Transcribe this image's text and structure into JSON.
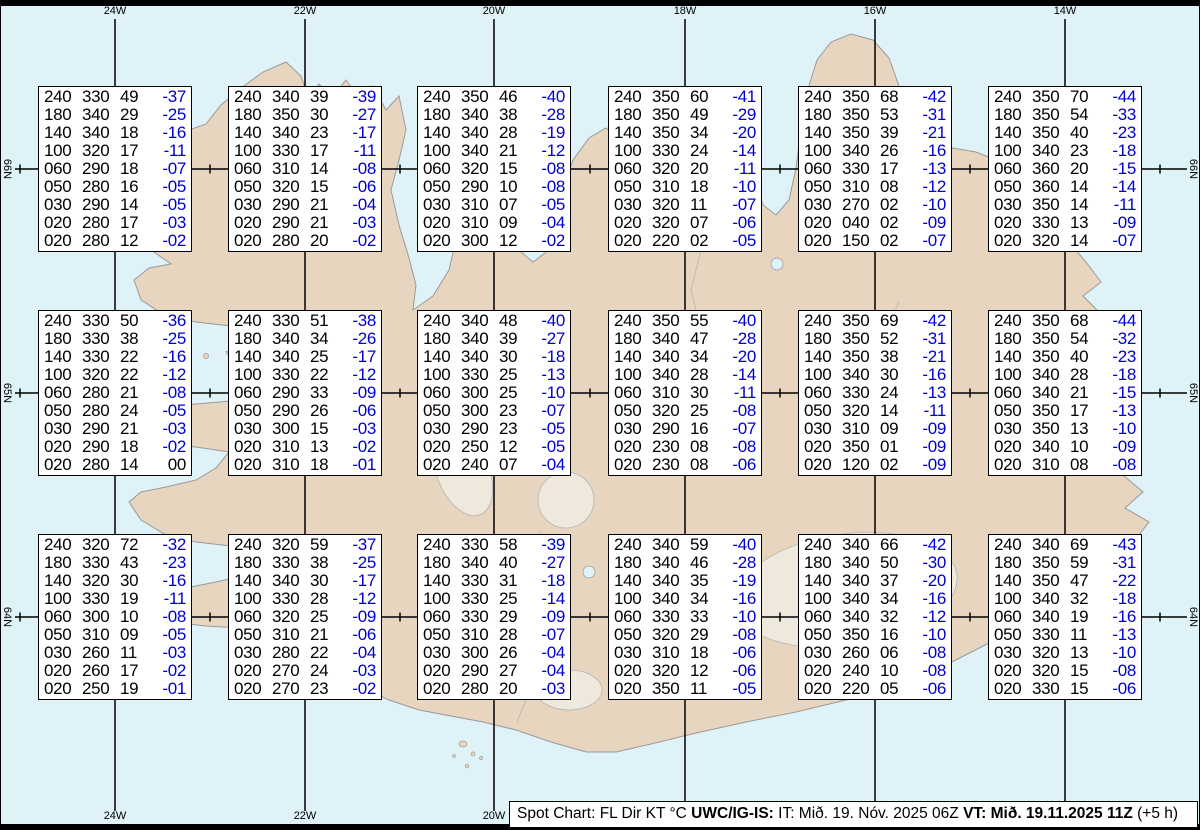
{
  "map": {
    "sea_color": "#dff2f8",
    "land_color": "#e7d5c0",
    "coast_color": "#9a9a9a",
    "grid_color": "#000000",
    "meridians": [
      {
        "label": "24W",
        "x": 114
      },
      {
        "label": "22W",
        "x": 304
      },
      {
        "label": "20W",
        "x": 493
      },
      {
        "label": "18W",
        "x": 684
      },
      {
        "label": "16W",
        "x": 874
      },
      {
        "label": "14W",
        "x": 1064
      }
    ],
    "parallels": [
      {
        "label": "66N",
        "y": 169
      },
      {
        "label": "65N",
        "y": 393
      },
      {
        "label": "64N",
        "y": 617
      }
    ],
    "degree_tick_start_x": 19,
    "degree_tick_spacing_x": 95
  },
  "columns": [
    "FL",
    "Dir",
    "KT",
    "°C"
  ],
  "spot_boxes": [
    {
      "rows": [
        [
          "240",
          "330",
          "49",
          "-37"
        ],
        [
          "180",
          "340",
          "29",
          "-25"
        ],
        [
          "140",
          "340",
          "18",
          "-16"
        ],
        [
          "100",
          "320",
          "17",
          "-11"
        ],
        [
          "060",
          "290",
          "18",
          "-07"
        ],
        [
          "050",
          "280",
          "16",
          "-05"
        ],
        [
          "030",
          "290",
          "14",
          "-05"
        ],
        [
          "020",
          "280",
          "17",
          "-03"
        ],
        [
          "020",
          "280",
          "12",
          "-02"
        ]
      ]
    },
    {
      "rows": [
        [
          "240",
          "340",
          "39",
          "-39"
        ],
        [
          "180",
          "350",
          "30",
          "-27"
        ],
        [
          "140",
          "340",
          "23",
          "-17"
        ],
        [
          "100",
          "330",
          "17",
          "-11"
        ],
        [
          "060",
          "310",
          "14",
          "-08"
        ],
        [
          "050",
          "320",
          "15",
          "-06"
        ],
        [
          "030",
          "290",
          "21",
          "-04"
        ],
        [
          "020",
          "290",
          "21",
          "-03"
        ],
        [
          "020",
          "280",
          "20",
          "-02"
        ]
      ]
    },
    {
      "rows": [
        [
          "240",
          "350",
          "46",
          "-40"
        ],
        [
          "180",
          "340",
          "38",
          "-28"
        ],
        [
          "140",
          "340",
          "28",
          "-19"
        ],
        [
          "100",
          "340",
          "21",
          "-12"
        ],
        [
          "060",
          "320",
          "15",
          "-08"
        ],
        [
          "050",
          "290",
          "10",
          "-08"
        ],
        [
          "030",
          "310",
          "07",
          "-05"
        ],
        [
          "020",
          "310",
          "09",
          "-04"
        ],
        [
          "020",
          "300",
          "12",
          "-02"
        ]
      ]
    },
    {
      "rows": [
        [
          "240",
          "350",
          "60",
          "-41"
        ],
        [
          "180",
          "350",
          "49",
          "-29"
        ],
        [
          "140",
          "350",
          "34",
          "-20"
        ],
        [
          "100",
          "330",
          "24",
          "-14"
        ],
        [
          "060",
          "320",
          "20",
          "-11"
        ],
        [
          "050",
          "310",
          "18",
          "-10"
        ],
        [
          "030",
          "320",
          "11",
          "-07"
        ],
        [
          "020",
          "320",
          "07",
          "-06"
        ],
        [
          "020",
          "220",
          "02",
          "-05"
        ]
      ]
    },
    {
      "rows": [
        [
          "240",
          "350",
          "68",
          "-42"
        ],
        [
          "180",
          "350",
          "53",
          "-31"
        ],
        [
          "140",
          "350",
          "39",
          "-21"
        ],
        [
          "100",
          "340",
          "26",
          "-16"
        ],
        [
          "060",
          "330",
          "17",
          "-13"
        ],
        [
          "050",
          "310",
          "08",
          "-12"
        ],
        [
          "030",
          "270",
          "02",
          "-10"
        ],
        [
          "020",
          "040",
          "02",
          "-09"
        ],
        [
          "020",
          "150",
          "02",
          "-07"
        ]
      ]
    },
    {
      "rows": [
        [
          "240",
          "350",
          "70",
          "-44"
        ],
        [
          "180",
          "350",
          "54",
          "-33"
        ],
        [
          "140",
          "350",
          "40",
          "-23"
        ],
        [
          "100",
          "340",
          "23",
          "-18"
        ],
        [
          "060",
          "360",
          "20",
          "-15"
        ],
        [
          "050",
          "360",
          "14",
          "-14"
        ],
        [
          "030",
          "350",
          "14",
          "-11"
        ],
        [
          "020",
          "330",
          "13",
          "-09"
        ],
        [
          "020",
          "320",
          "14",
          "-07"
        ]
      ]
    },
    {
      "rows": [
        [
          "240",
          "330",
          "50",
          "-36"
        ],
        [
          "180",
          "330",
          "38",
          "-25"
        ],
        [
          "140",
          "330",
          "22",
          "-16"
        ],
        [
          "100",
          "320",
          "22",
          "-12"
        ],
        [
          "060",
          "280",
          "21",
          "-08"
        ],
        [
          "050",
          "280",
          "24",
          "-05"
        ],
        [
          "030",
          "290",
          "21",
          "-03"
        ],
        [
          "020",
          "290",
          "18",
          "-02"
        ],
        [
          "020",
          "280",
          "14",
          "00"
        ]
      ]
    },
    {
      "rows": [
        [
          "240",
          "330",
          "51",
          "-38"
        ],
        [
          "180",
          "340",
          "34",
          "-26"
        ],
        [
          "140",
          "340",
          "25",
          "-17"
        ],
        [
          "100",
          "330",
          "22",
          "-12"
        ],
        [
          "060",
          "290",
          "33",
          "-09"
        ],
        [
          "050",
          "290",
          "26",
          "-06"
        ],
        [
          "030",
          "300",
          "15",
          "-03"
        ],
        [
          "020",
          "310",
          "13",
          "-02"
        ],
        [
          "020",
          "310",
          "18",
          "-01"
        ]
      ]
    },
    {
      "rows": [
        [
          "240",
          "340",
          "48",
          "-40"
        ],
        [
          "180",
          "340",
          "39",
          "-27"
        ],
        [
          "140",
          "340",
          "30",
          "-18"
        ],
        [
          "100",
          "330",
          "25",
          "-13"
        ],
        [
          "060",
          "300",
          "25",
          "-10"
        ],
        [
          "050",
          "300",
          "23",
          "-07"
        ],
        [
          "030",
          "290",
          "23",
          "-05"
        ],
        [
          "020",
          "250",
          "12",
          "-05"
        ],
        [
          "020",
          "240",
          "07",
          "-04"
        ]
      ]
    },
    {
      "rows": [
        [
          "240",
          "350",
          "55",
          "-40"
        ],
        [
          "180",
          "340",
          "47",
          "-28"
        ],
        [
          "140",
          "340",
          "34",
          "-20"
        ],
        [
          "100",
          "340",
          "28",
          "-14"
        ],
        [
          "060",
          "310",
          "30",
          "-11"
        ],
        [
          "050",
          "320",
          "25",
          "-08"
        ],
        [
          "030",
          "290",
          "16",
          "-07"
        ],
        [
          "020",
          "230",
          "08",
          "-08"
        ],
        [
          "020",
          "230",
          "08",
          "-06"
        ]
      ]
    },
    {
      "rows": [
        [
          "240",
          "350",
          "69",
          "-42"
        ],
        [
          "180",
          "350",
          "52",
          "-31"
        ],
        [
          "140",
          "350",
          "38",
          "-21"
        ],
        [
          "100",
          "340",
          "30",
          "-16"
        ],
        [
          "060",
          "330",
          "24",
          "-13"
        ],
        [
          "050",
          "320",
          "14",
          "-11"
        ],
        [
          "030",
          "310",
          "09",
          "-09"
        ],
        [
          "020",
          "350",
          "01",
          "-09"
        ],
        [
          "020",
          "120",
          "02",
          "-09"
        ]
      ]
    },
    {
      "rows": [
        [
          "240",
          "350",
          "68",
          "-44"
        ],
        [
          "180",
          "350",
          "54",
          "-32"
        ],
        [
          "140",
          "350",
          "40",
          "-23"
        ],
        [
          "100",
          "340",
          "28",
          "-18"
        ],
        [
          "060",
          "340",
          "21",
          "-15"
        ],
        [
          "050",
          "350",
          "17",
          "-13"
        ],
        [
          "030",
          "350",
          "13",
          "-10"
        ],
        [
          "020",
          "340",
          "10",
          "-09"
        ],
        [
          "020",
          "310",
          "08",
          "-08"
        ]
      ]
    },
    {
      "rows": [
        [
          "240",
          "320",
          "72",
          "-32"
        ],
        [
          "180",
          "330",
          "43",
          "-23"
        ],
        [
          "140",
          "320",
          "30",
          "-16"
        ],
        [
          "100",
          "330",
          "19",
          "-11"
        ],
        [
          "060",
          "300",
          "10",
          "-08"
        ],
        [
          "050",
          "310",
          "09",
          "-05"
        ],
        [
          "030",
          "260",
          "11",
          "-03"
        ],
        [
          "020",
          "260",
          "17",
          "-02"
        ],
        [
          "020",
          "250",
          "19",
          "-01"
        ]
      ]
    },
    {
      "rows": [
        [
          "240",
          "320",
          "59",
          "-37"
        ],
        [
          "180",
          "330",
          "38",
          "-25"
        ],
        [
          "140",
          "340",
          "30",
          "-17"
        ],
        [
          "100",
          "330",
          "28",
          "-12"
        ],
        [
          "060",
          "320",
          "25",
          "-09"
        ],
        [
          "050",
          "310",
          "21",
          "-06"
        ],
        [
          "030",
          "280",
          "22",
          "-04"
        ],
        [
          "020",
          "270",
          "24",
          "-03"
        ],
        [
          "020",
          "270",
          "23",
          "-02"
        ]
      ]
    },
    {
      "rows": [
        [
          "240",
          "330",
          "58",
          "-39"
        ],
        [
          "180",
          "340",
          "40",
          "-27"
        ],
        [
          "140",
          "330",
          "31",
          "-18"
        ],
        [
          "100",
          "330",
          "25",
          "-14"
        ],
        [
          "060",
          "330",
          "29",
          "-09"
        ],
        [
          "050",
          "310",
          "28",
          "-07"
        ],
        [
          "030",
          "300",
          "26",
          "-04"
        ],
        [
          "020",
          "290",
          "27",
          "-04"
        ],
        [
          "020",
          "280",
          "20",
          "-03"
        ]
      ]
    },
    {
      "rows": [
        [
          "240",
          "340",
          "59",
          "-40"
        ],
        [
          "180",
          "340",
          "46",
          "-28"
        ],
        [
          "140",
          "340",
          "35",
          "-19"
        ],
        [
          "100",
          "340",
          "34",
          "-16"
        ],
        [
          "060",
          "330",
          "33",
          "-10"
        ],
        [
          "050",
          "320",
          "29",
          "-08"
        ],
        [
          "030",
          "310",
          "18",
          "-06"
        ],
        [
          "020",
          "320",
          "12",
          "-06"
        ],
        [
          "020",
          "350",
          "11",
          "-05"
        ]
      ]
    },
    {
      "rows": [
        [
          "240",
          "340",
          "66",
          "-42"
        ],
        [
          "180",
          "340",
          "50",
          "-30"
        ],
        [
          "140",
          "340",
          "37",
          "-20"
        ],
        [
          "100",
          "340",
          "34",
          "-16"
        ],
        [
          "060",
          "340",
          "32",
          "-12"
        ],
        [
          "050",
          "350",
          "16",
          "-10"
        ],
        [
          "030",
          "260",
          "06",
          "-08"
        ],
        [
          "020",
          "240",
          "10",
          "-08"
        ],
        [
          "020",
          "220",
          "05",
          "-06"
        ]
      ]
    },
    {
      "rows": [
        [
          "240",
          "340",
          "69",
          "-43"
        ],
        [
          "180",
          "350",
          "59",
          "-31"
        ],
        [
          "140",
          "350",
          "47",
          "-22"
        ],
        [
          "100",
          "340",
          "32",
          "-18"
        ],
        [
          "060",
          "340",
          "19",
          "-16"
        ],
        [
          "050",
          "330",
          "11",
          "-13"
        ],
        [
          "030",
          "320",
          "13",
          "-10"
        ],
        [
          "020",
          "320",
          "15",
          "-08"
        ],
        [
          "020",
          "330",
          "15",
          "-06"
        ]
      ]
    }
  ],
  "status_bar": {
    "prefix": "Spot Chart: FL Dir KT °C ",
    "source": "UWC/IG-IS:",
    "issue": " IT: Mið. 19. Nóv. 2025 06Z ",
    "valid": "VT: Mið. 19.11.2025 11Z",
    "suffix": " (+5 h)"
  },
  "colors": {
    "temp": "#0000cd",
    "text": "#000000"
  }
}
